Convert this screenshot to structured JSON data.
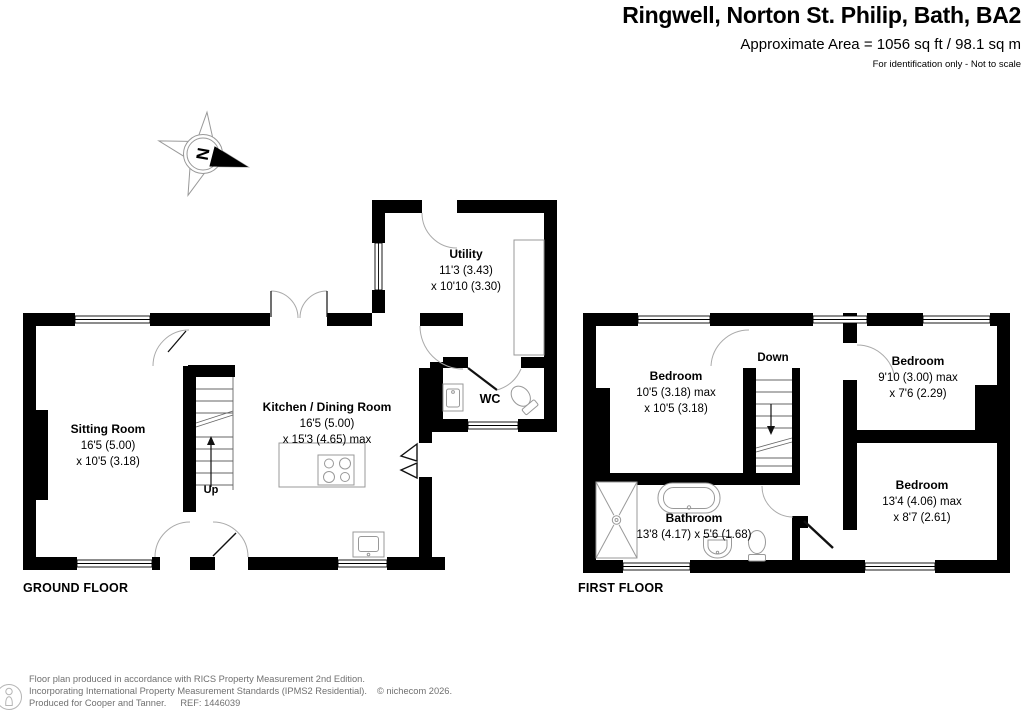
{
  "header": {
    "title": "Ringwell, Norton St. Philip, Bath, BA2",
    "area": "Approximate Area = 1056 sq ft / 98.1 sq m",
    "disclaimer": "For identification only - Not to scale"
  },
  "compass": {
    "letter": "N"
  },
  "ground_floor": {
    "label": "GROUND FLOOR",
    "stairs_label": "Up",
    "rooms": {
      "sitting_room": {
        "name": "Sitting Room",
        "dim1": "16'5 (5.00)",
        "dim2": "x 10'5 (3.18)"
      },
      "kitchen_dining": {
        "name": "Kitchen / Dining Room",
        "dim1": "16'5 (5.00)",
        "dim2": "x 15'3 (4.65) max"
      },
      "utility": {
        "name": "Utility",
        "dim1": "11'3 (3.43)",
        "dim2": "x 10'10 (3.30)"
      },
      "wc": {
        "name": "WC"
      }
    }
  },
  "first_floor": {
    "label": "FIRST FLOOR",
    "stairs_label": "Down",
    "rooms": {
      "bedroom_1": {
        "name": "Bedroom",
        "dim1": "10'5 (3.18) max",
        "dim2": "x 10'5 (3.18)"
      },
      "bedroom_2": {
        "name": "Bedroom",
        "dim1": "9'10 (3.00) max",
        "dim2": "x 7'6 (2.29)"
      },
      "bedroom_3": {
        "name": "Bedroom",
        "dim1": "13'4 (4.06) max",
        "dim2": "x 8'7 (2.61)"
      },
      "bathroom": {
        "name": "Bathroom",
        "dim1": "13'8 (4.17) x 5'6 (1.68)"
      }
    }
  },
  "footer": {
    "line1": "Floor plan produced in accordance with RICS Property Measurement 2nd Edition.",
    "line2": "Incorporating International Property Measurement Standards (IPMS2 Residential).",
    "copyright": "© nichecom 2026.",
    "line3_left": "Produced for Cooper and Tanner.",
    "line3_ref": "REF: 1446039"
  },
  "colors": {
    "wall": "#000000",
    "door_arc": "#aaaaaa",
    "fixture_line": "#999999",
    "footer_text": "#707070"
  }
}
